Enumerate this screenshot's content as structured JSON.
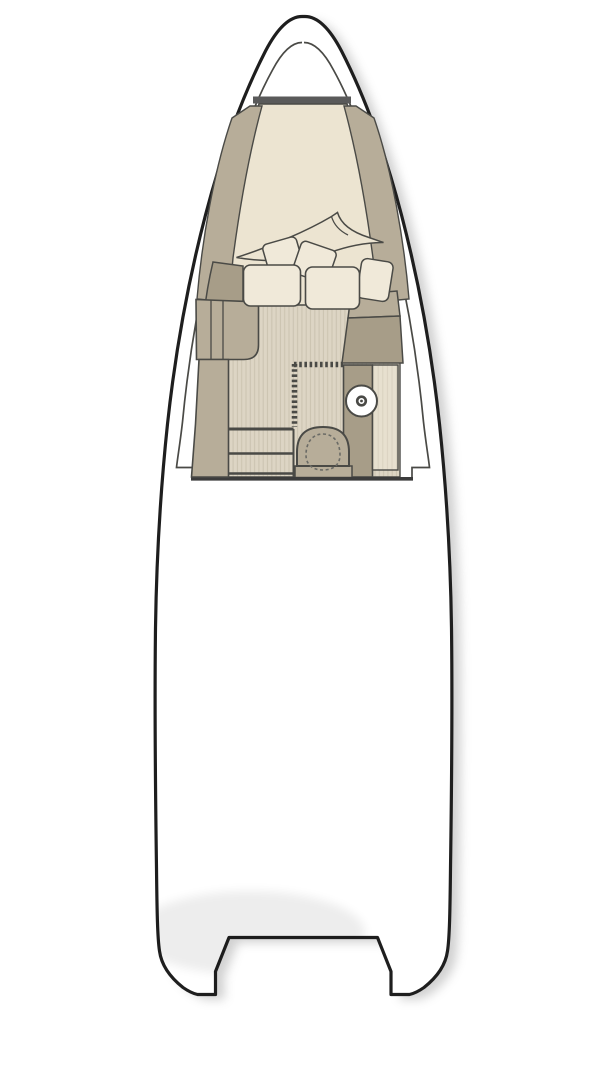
{
  "diagram": {
    "kind": "boat-floor-plan-top-view",
    "elements": {
      "hull": "hull-outline",
      "bow_cabin": "v-berth-cabin",
      "bed": "v-berth-mattress",
      "bedding": "blanket-and-pillows",
      "port_side": "cabinet-lockers-steps",
      "head": "toilet-sink-counter",
      "aft": "open-deck",
      "stern": "transom-notch"
    }
  },
  "colors": {
    "white": "#ffffff",
    "outline_heavy": "#1e1e1e",
    "outline": "#4a4a46",
    "outline_soft": "#6b6b66",
    "aft_line": "#3c3c3c",
    "bulkhead_gray": "#5a5a5a",
    "cream": "#ece4d1",
    "cream_light": "#f0e9d9",
    "tan": "#b7ad99",
    "tan_dark": "#a79d88",
    "floor_base": "#ddd5c4",
    "floor_stripe": "#ccc4b1",
    "counter_base": "#e7e0cf",
    "counter_stripe": "#d9d2c0",
    "shadow": "#9a9a9a"
  }
}
